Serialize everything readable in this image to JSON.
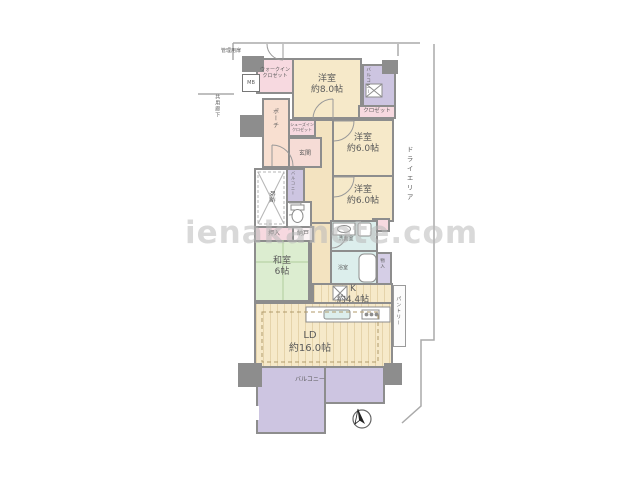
{
  "watermark": "ienakanote.com",
  "labels": {
    "management_door": "管理用扉",
    "common_corridor": "共用廊下",
    "mb": "MB",
    "wic": "ウォークイン\nクロゼット",
    "bed8": "洋室\n約8.0帖",
    "balcony_top": "バルコニー",
    "closet": "クロゼット",
    "bed6a": "洋室\n約6.0帖",
    "bed6b": "洋室\n約6.0帖",
    "porch": "ポーチ",
    "sic": "シューズイン\nクロゼット",
    "genkan": "玄関",
    "fukinuke": "吹抜",
    "balcony_mid": "バルコニー",
    "oshiire": "押入",
    "nando": "納戸",
    "washitsu": "和室\n6帖",
    "senmen": "洗面室",
    "bath": "浴室",
    "monoire": "物入",
    "kitchen": "K\n約4.4帖",
    "pantry": "パントリー",
    "ld": "LD\n約16.0帖",
    "balcony_bottom": "バルコニー",
    "dry_area": "ドライエリア"
  },
  "colors": {
    "wall": "#8d8d8d",
    "western_room": "#F6E9C9",
    "tatami_room": "#DCEDD0",
    "balcony": "#CDC5E1",
    "closet": "#F7D9E0",
    "porch": "#F8DFD0",
    "wet_area": "#DCEEEC",
    "watermark_gray": "#BBBBBB"
  }
}
